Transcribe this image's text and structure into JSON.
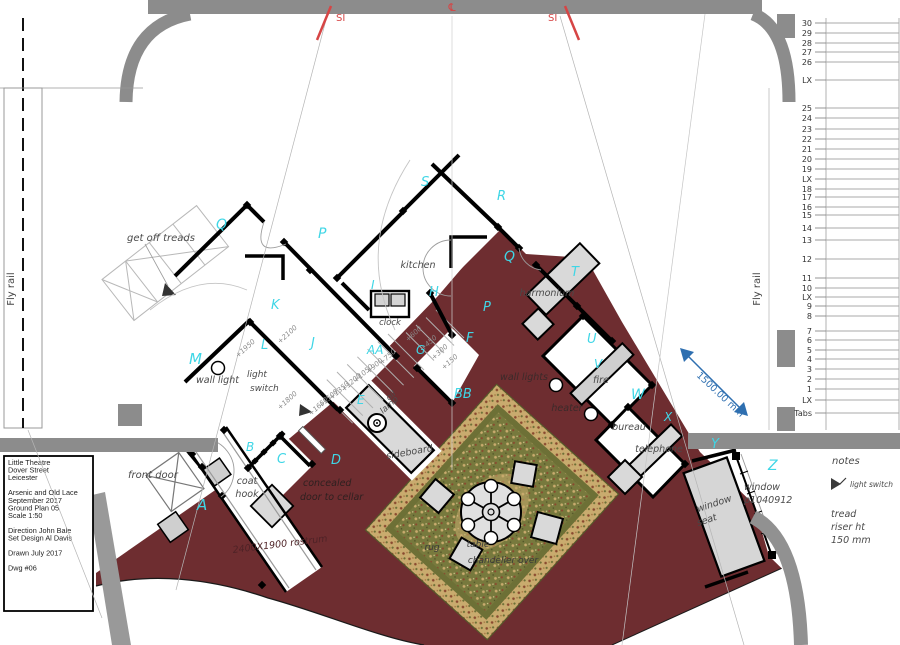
{
  "document": {
    "type": "theatre-ground-plan",
    "colors": {
      "floor_red": "#6e2d30",
      "wall_gray": "#8c8c8c",
      "furniture_gray": "#d9d9d9",
      "cyan_letter": "#3fd6e6",
      "dim_gray": "#8a8a8a",
      "red_mark": "#d64545",
      "blue_dim": "#2e6fb0",
      "rug_border": "#c9ab6e",
      "rug_field": "#77793d"
    }
  },
  "title_block": {
    "lines": [
      "Little Theatre",
      "Dover Street",
      "Leicester",
      "",
      "Arsenic and Old Lace",
      "September 2017",
      "Ground Plan 05",
      "Scale 1:50",
      "",
      "Direction John Bale",
      "Set Design Al Davis",
      "",
      "Drawn July 2017",
      "",
      "Dwg #06"
    ]
  },
  "fly_bars": [
    {
      "t": "30",
      "y": 23
    },
    {
      "t": "29",
      "y": 33
    },
    {
      "t": "28",
      "y": 43
    },
    {
      "t": "27",
      "y": 52
    },
    {
      "t": "26",
      "y": 62
    },
    {
      "t": "LX",
      "y": 80
    },
    {
      "t": "25",
      "y": 108
    },
    {
      "t": "24",
      "y": 118
    },
    {
      "t": "23",
      "y": 129
    },
    {
      "t": "22",
      "y": 139
    },
    {
      "t": "21",
      "y": 149
    },
    {
      "t": "20",
      "y": 159
    },
    {
      "t": "19",
      "y": 169
    },
    {
      "t": "LX",
      "y": 179
    },
    {
      "t": "18",
      "y": 189
    },
    {
      "t": "17",
      "y": 197
    },
    {
      "t": "16",
      "y": 207
    },
    {
      "t": "15",
      "y": 215
    },
    {
      "t": "14",
      "y": 228
    },
    {
      "t": "13",
      "y": 240
    },
    {
      "t": "12",
      "y": 259
    },
    {
      "t": "11",
      "y": 278
    },
    {
      "t": "10",
      "y": 288
    },
    {
      "t": "LX",
      "y": 297
    },
    {
      "t": "9",
      "y": 306
    },
    {
      "t": "8",
      "y": 316
    },
    {
      "t": "7",
      "y": 331
    },
    {
      "t": "6",
      "y": 340
    },
    {
      "t": "5",
      "y": 350
    },
    {
      "t": "4",
      "y": 359
    },
    {
      "t": "3",
      "y": 369
    },
    {
      "t": "2",
      "y": 379
    },
    {
      "t": "1",
      "y": 389
    },
    {
      "t": "LX",
      "y": 400
    },
    {
      "t": "Tabs",
      "y": 413
    }
  ],
  "letters": [
    {
      "t": "A",
      "x": 197,
      "y": 510,
      "s": 15
    },
    {
      "t": "B",
      "x": 246,
      "y": 451,
      "s": 12
    },
    {
      "t": "C",
      "x": 277,
      "y": 463,
      "s": 13
    },
    {
      "t": "D",
      "x": 331,
      "y": 464,
      "s": 13
    },
    {
      "t": "E",
      "x": 357,
      "y": 404,
      "s": 12
    },
    {
      "t": "F",
      "x": 466,
      "y": 342,
      "s": 13
    },
    {
      "t": "G",
      "x": 416,
      "y": 354,
      "s": 12
    },
    {
      "t": "H",
      "x": 429,
      "y": 296,
      "s": 13
    },
    {
      "t": "I",
      "x": 371,
      "y": 289,
      "s": 12
    },
    {
      "t": "J",
      "x": 311,
      "y": 347,
      "s": 13
    },
    {
      "t": "K",
      "x": 271,
      "y": 309,
      "s": 13
    },
    {
      "t": "L",
      "x": 261,
      "y": 349,
      "s": 13
    },
    {
      "t": "M",
      "x": 189,
      "y": 364,
      "s": 15
    },
    {
      "t": "P",
      "x": 318,
      "y": 238,
      "s": 14
    },
    {
      "t": "P",
      "x": 483,
      "y": 311,
      "s": 13
    },
    {
      "t": "Q",
      "x": 216,
      "y": 229,
      "s": 14
    },
    {
      "t": "Q",
      "x": 504,
      "y": 261,
      "s": 14
    },
    {
      "t": "R",
      "x": 497,
      "y": 200,
      "s": 13
    },
    {
      "t": "S",
      "x": 421,
      "y": 186,
      "s": 13
    },
    {
      "t": "T",
      "x": 571,
      "y": 276,
      "s": 13
    },
    {
      "t": "U",
      "x": 587,
      "y": 343,
      "s": 13
    },
    {
      "t": "V",
      "x": 594,
      "y": 368,
      "s": 12
    },
    {
      "t": "W",
      "x": 631,
      "y": 399,
      "s": 14
    },
    {
      "t": "X",
      "x": 664,
      "y": 421,
      "s": 12
    },
    {
      "t": "Y",
      "x": 711,
      "y": 448,
      "s": 13
    },
    {
      "t": "Z",
      "x": 768,
      "y": 470,
      "s": 14
    },
    {
      "t": "AA",
      "x": 367,
      "y": 354,
      "s": 12
    },
    {
      "t": "BB",
      "x": 454,
      "y": 398,
      "s": 13
    }
  ],
  "texts": [
    {
      "n": "label-get-off-treads",
      "t": "get off treads",
      "x": 127,
      "y": 241,
      "s": 10
    },
    {
      "n": "label-wall-light",
      "t": "wall light",
      "x": 196,
      "y": 383
    },
    {
      "n": "label-light",
      "t": "light",
      "x": 247,
      "y": 377,
      "s": 9
    },
    {
      "n": "label-switch",
      "t": "switch",
      "x": 250,
      "y": 391,
      "s": 9
    },
    {
      "n": "label-clock",
      "t": "clock",
      "x": 390,
      "y": 325,
      "s": 8.5,
      "a": "middle"
    },
    {
      "n": "label-kitchen",
      "t": "kitchen",
      "x": 418,
      "y": 268,
      "a": "middle"
    },
    {
      "n": "label-harmonium",
      "t": "harmonium",
      "x": 547,
      "y": 296,
      "a": "middle"
    },
    {
      "n": "label-wall-lights",
      "t": "wall lights",
      "x": 524,
      "y": 380,
      "a": "middle",
      "c": "#3b2a2a"
    },
    {
      "n": "label-fire",
      "t": "fire",
      "x": 601,
      "y": 383,
      "a": "middle"
    },
    {
      "n": "label-heater",
      "t": "heater",
      "x": 567,
      "y": 411,
      "a": "middle",
      "c": "#3b2a2a"
    },
    {
      "n": "label-bureau",
      "t": "bureau",
      "x": 629,
      "y": 430,
      "a": "middle"
    },
    {
      "n": "label-telephone",
      "t": "telephone",
      "x": 659,
      "y": 452,
      "a": "middle"
    },
    {
      "n": "label-oil",
      "t": "oil",
      "x": 389,
      "y": 401,
      "s": 8.5,
      "r": -42
    },
    {
      "n": "label-lamp",
      "t": "lamp",
      "x": 383,
      "y": 414,
      "s": 8.5,
      "r": -42
    },
    {
      "n": "label-sideboard",
      "t": "sideboard",
      "x": 410,
      "y": 455,
      "a": "middle",
      "r": -10
    },
    {
      "n": "label-concealed",
      "t": "concealed",
      "x": 303,
      "y": 486,
      "c": "#2e2020"
    },
    {
      "n": "label-door-to-cellar",
      "t": "door to cellar",
      "x": 300,
      "y": 500,
      "c": "#2e2020"
    },
    {
      "n": "label-front-door",
      "t": "front door",
      "x": 128,
      "y": 478,
      "s": 10
    },
    {
      "n": "label-coat",
      "t": "coat",
      "x": 247,
      "y": 484,
      "a": "middle"
    },
    {
      "n": "label-hook",
      "t": "hook",
      "x": 247,
      "y": 497,
      "a": "middle"
    },
    {
      "n": "label-rostrum",
      "t": "2400X1900 rostrum",
      "x": 233,
      "y": 553,
      "r": -7,
      "c": "#4e2226"
    },
    {
      "n": "label-rug",
      "t": "rug",
      "x": 432,
      "y": 550,
      "s": 9,
      "c": "#3a3a3a",
      "a": "middle"
    },
    {
      "n": "label-table",
      "t": "table",
      "x": 478,
      "y": 547,
      "s": 9,
      "c": "#3a3a3a",
      "a": "middle"
    },
    {
      "n": "label-chandelier-over",
      "t": "chandelier over",
      "x": 503,
      "y": 563,
      "s": 9,
      "c": "#3a3a3a",
      "a": "middle"
    },
    {
      "n": "label-window",
      "t": "window",
      "x": 744,
      "y": 490,
      "s": 9.5
    },
    {
      "n": "label-window-id",
      "t": "p1040912",
      "x": 744,
      "y": 503,
      "s": 9.5
    },
    {
      "n": "label-window-seat-1",
      "t": "window",
      "x": 698,
      "y": 512,
      "r": -18,
      "c": "#454545"
    },
    {
      "n": "label-window-seat-2",
      "t": "seat",
      "x": 698,
      "y": 526,
      "r": -18,
      "c": "#454545"
    },
    {
      "n": "notes-title",
      "t": "notes",
      "x": 832,
      "y": 464,
      "s": 10
    },
    {
      "n": "legend-light-switch",
      "t": "light switch",
      "x": 850,
      "y": 487,
      "s": 7.5
    },
    {
      "n": "note-tread",
      "t": "tread",
      "x": 831,
      "y": 517,
      "s": 9.5
    },
    {
      "n": "note-riser",
      "t": "riser ht",
      "x": 831,
      "y": 530,
      "s": 9.5
    },
    {
      "n": "note-150",
      "t": "150 mm",
      "x": 831,
      "y": 543,
      "s": 9.5
    },
    {
      "n": "fly-rail-left-label",
      "t": "Fly rail",
      "x": 14,
      "y": 289,
      "r": -90,
      "s": 10,
      "a": "middle",
      "up": 1,
      "c": "#444444"
    },
    {
      "n": "fly-rail-right-label",
      "t": "Fly rail",
      "x": 760,
      "y": 289,
      "r": -90,
      "s": 10,
      "a": "middle",
      "up": 1,
      "c": "#444444"
    },
    {
      "n": "mark-si-left",
      "t": "SI",
      "x": 336,
      "y": 21,
      "s": 10,
      "c": "#d64545",
      "up": 1
    },
    {
      "n": "mark-si-right",
      "t": "SI",
      "x": 548,
      "y": 21,
      "s": 10,
      "c": "#d64545",
      "up": 1
    },
    {
      "n": "mark-centerline",
      "t": "℄",
      "x": 452,
      "y": 11,
      "s": 11,
      "c": "#d64545",
      "a": "middle",
      "up": 1
    },
    {
      "n": "dim-1500mm",
      "t": "1500.00 mm",
      "x": 696,
      "y": 376,
      "r": 43,
      "s": 9.5,
      "c": "#2e6fb0",
      "up": 1
    },
    {
      "n": "level-2100",
      "t": "+2100",
      "x": 280,
      "y": 344,
      "s": 7,
      "c": "#8a8a8a",
      "r": -42
    },
    {
      "n": "level-1950",
      "t": "+1950",
      "x": 238,
      "y": 358,
      "s": 7,
      "c": "#8a8a8a",
      "r": -42
    },
    {
      "n": "level-1800",
      "t": "+1800",
      "x": 280,
      "y": 410,
      "s": 7,
      "c": "#8a8a8a",
      "r": -42
    },
    {
      "n": "level-750",
      "t": "+750",
      "x": 382,
      "y": 365,
      "s": 7,
      "c": "#8a8a8a",
      "r": -42
    },
    {
      "n": "level-900",
      "t": "+900",
      "x": 369,
      "y": 374,
      "s": 7,
      "c": "#8a8a8a",
      "r": -42
    },
    {
      "n": "level-1050",
      "t": "+1050",
      "x": 356,
      "y": 383,
      "s": 7,
      "c": "#8a8a8a",
      "r": -42
    },
    {
      "n": "level-1200",
      "t": "+1200",
      "x": 344,
      "y": 392,
      "s": 7,
      "c": "#8a8a8a",
      "r": -42
    },
    {
      "n": "level-1350",
      "t": "+1350",
      "x": 332,
      "y": 400,
      "s": 7,
      "c": "#8a8a8a",
      "r": -42
    },
    {
      "n": "level-1500",
      "t": "+1500",
      "x": 321,
      "y": 408,
      "s": 7,
      "c": "#8a8a8a",
      "r": -42
    },
    {
      "n": "level-1650",
      "t": "+1650",
      "x": 311,
      "y": 416,
      "s": 7,
      "c": "#8a8a8a",
      "r": -42
    },
    {
      "n": "level-600",
      "t": "+600",
      "x": 408,
      "y": 342,
      "s": 7,
      "c": "#8a8a8a",
      "r": -42
    },
    {
      "n": "level-450",
      "t": "+450",
      "x": 423,
      "y": 351,
      "s": 7,
      "c": "#8a8a8a",
      "r": -42
    },
    {
      "n": "level-300",
      "t": "+300",
      "x": 434,
      "y": 360,
      "s": 7,
      "c": "#8a8a8a",
      "r": -42
    },
    {
      "n": "level-150",
      "t": "+150",
      "x": 444,
      "y": 370,
      "s": 7,
      "c": "#8a8a8a",
      "r": -42
    }
  ]
}
